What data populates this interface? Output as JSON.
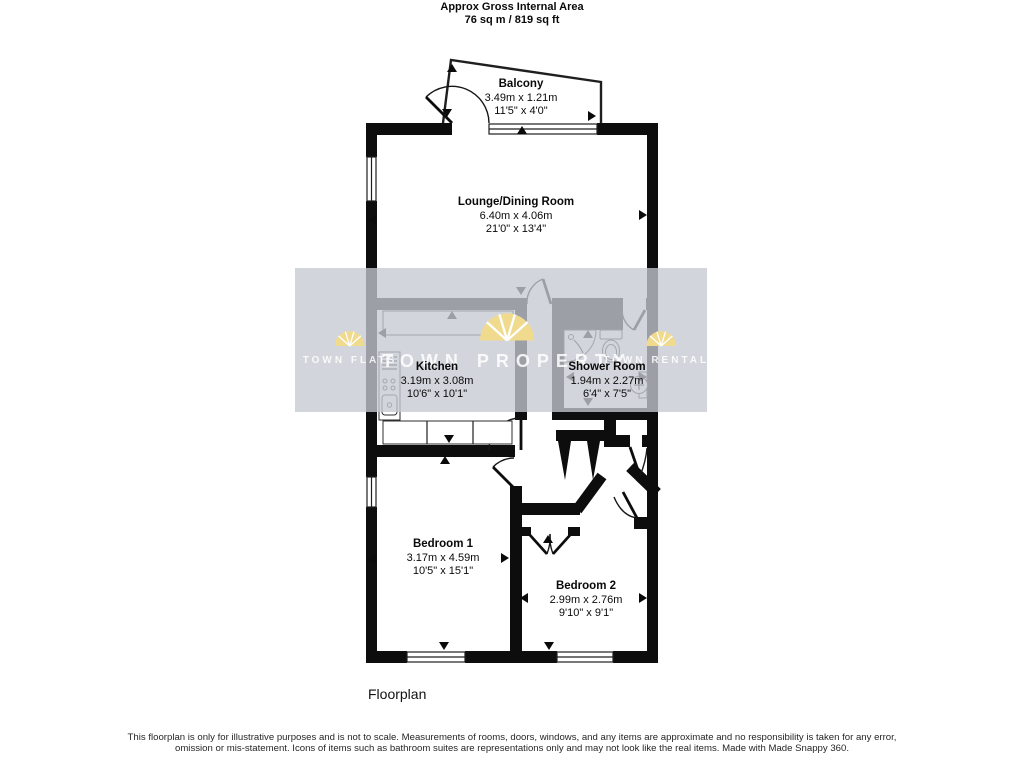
{
  "header": {
    "line1": "Approx Gross Internal Area",
    "line2": "76 sq m / 819 sq ft"
  },
  "rooms": {
    "balcony": {
      "name": "Balcony",
      "metric": "3.49m x 1.21m",
      "imperial": "11'5\" x 4'0\""
    },
    "lounge": {
      "name": "Lounge/Dining Room",
      "metric": "6.40m x 4.06m",
      "imperial": "21'0\" x 13'4\""
    },
    "kitchen": {
      "name": "Kitchen",
      "metric": "3.19m x 3.08m",
      "imperial": "10'6\" x 10'1\""
    },
    "shower": {
      "name": "Shower Room",
      "metric": "1.94m x 2.27m",
      "imperial": "6'4\" x 7'5\""
    },
    "bedroom1": {
      "name": "Bedroom 1",
      "metric": "3.17m x 4.59m",
      "imperial": "10'5\" x 15'1\""
    },
    "bedroom2": {
      "name": "Bedroom 2",
      "metric": "2.99m x 2.76m",
      "imperial": "9'10\" x 9'1\""
    }
  },
  "watermark": {
    "left": "TOWN FLATS",
    "center": "TOWN PROPERTY",
    "right": "TOWN RENTALS"
  },
  "footer": {
    "caption": "Floorplan",
    "disclaimer": "This floorplan is only for illustrative purposes and is not to scale. Measurements of rooms, doors, windows, and any items are approximate and no responsibility is taken for any error, omission or mis-statement. Icons of items such as bathroom suites are representations only and may not look like the real items. Made with Made Snappy 360."
  },
  "colors": {
    "wall": "#0d0d0d",
    "watermark_band": "rgba(198,201,210,0.78)",
    "logo_yellow": "#f0da8e",
    "logo_text": "rgba(255,255,255,0.85)"
  }
}
